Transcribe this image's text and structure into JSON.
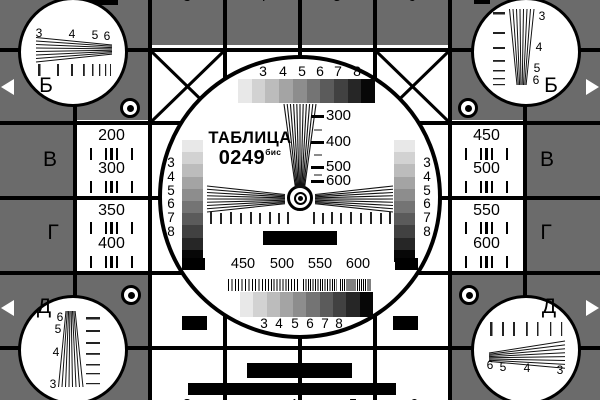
{
  "card": {
    "title": "ТАБЛИЦА",
    "number": "0249",
    "suffix": "бис"
  },
  "side_letters": {
    "left": [
      "Б",
      "В",
      "Г",
      "Д"
    ],
    "right": [
      "Б",
      "В",
      "Г",
      "Д"
    ]
  },
  "left_panel": {
    "values": [
      "200",
      "300",
      "350",
      "400"
    ]
  },
  "right_panel": {
    "values": [
      "450",
      "500",
      "550",
      "600"
    ]
  },
  "circle": {
    "top_gray_labels": [
      "3",
      "4",
      "5",
      "6",
      "7",
      "8"
    ],
    "bottom_gray_labels": [
      "3",
      "4",
      "5",
      "6",
      "7",
      "8"
    ],
    "left_gray_labels": [
      "3",
      "4",
      "5",
      "6",
      "7",
      "8"
    ],
    "right_gray_labels": [
      "3",
      "4",
      "5",
      "6",
      "7",
      "8"
    ],
    "wedge_labels": [
      "300",
      "400",
      "500",
      "600"
    ],
    "burst_labels": [
      "450",
      "500",
      "550",
      "600"
    ]
  },
  "corner_circles": {
    "top_left": [
      "3",
      "4",
      "5",
      "6"
    ],
    "top_right": [
      "3",
      "4",
      "5",
      "6"
    ],
    "bottom_left": [
      "6",
      "5",
      "4",
      "3"
    ],
    "bottom_right": [
      "6",
      "5",
      "4",
      "3"
    ]
  },
  "edge_digits": {
    "top": [
      "3",
      "4",
      "5",
      "6"
    ],
    "bottom": [
      "3",
      "4",
      "5",
      "6"
    ]
  },
  "colors": {
    "background_gray": "#6b6b6b",
    "line_black": "#000000",
    "white": "#ffffff"
  },
  "grayscale_steps": [
    "#e8e8e8",
    "#d2d2d2",
    "#bcbcbc",
    "#a4a4a4",
    "#8d8d8d",
    "#747474",
    "#5b5b5b",
    "#414141",
    "#262626",
    "#070707"
  ]
}
